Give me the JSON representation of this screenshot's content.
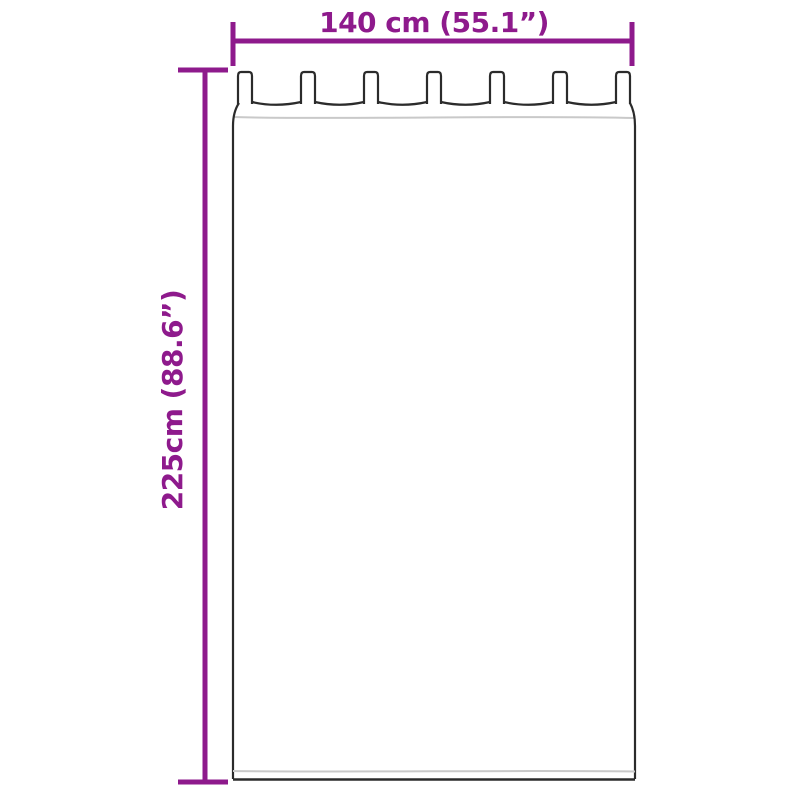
{
  "colors": {
    "dimension": "#8e1a8c",
    "outline": "#2b2b2b",
    "seam": "#c9c9c9",
    "background": "#ffffff"
  },
  "dimensions": {
    "width_label": "140 cm (55.1”)",
    "height_label": "225cm (88.6”)"
  },
  "illustration": {
    "type": "tab-top-curtain",
    "tab_count": 7
  }
}
